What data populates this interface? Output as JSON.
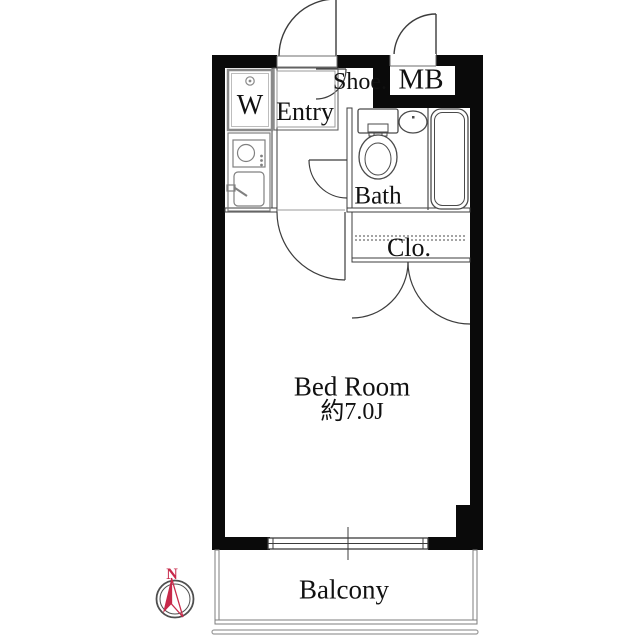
{
  "floorplan": {
    "title": "1K apartment floor plan",
    "labels": {
      "washer": "W",
      "entry": "Entry",
      "shoe": "Shoe.",
      "meter_box": "MB",
      "bath": "Bath",
      "closet": "Clo.",
      "bedroom_name": "Bed Room",
      "bedroom_size": "約7.0J",
      "balcony": "Balcony",
      "compass_north": "N"
    },
    "icons": {
      "compass": "compass-north-arrow",
      "toilet": "toilet-icon",
      "washbasin": "washbasin-icon",
      "bathtub": "bathtub-icon",
      "stove": "stove-icon",
      "kitchen_sink": "kitchen-sink-icon",
      "washer_tap": "washer-tap-icon",
      "sliding_window": "sliding-window-icon"
    },
    "colors": {
      "wall": "#0a0a0a",
      "thin_line": "#3c3c3c",
      "fixture_line": "#808080",
      "compass_red": "#c7294a",
      "balcony_line": "#7d7d7d",
      "boundary_line": "#9a9a9a",
      "background": "#ffffff"
    }
  }
}
